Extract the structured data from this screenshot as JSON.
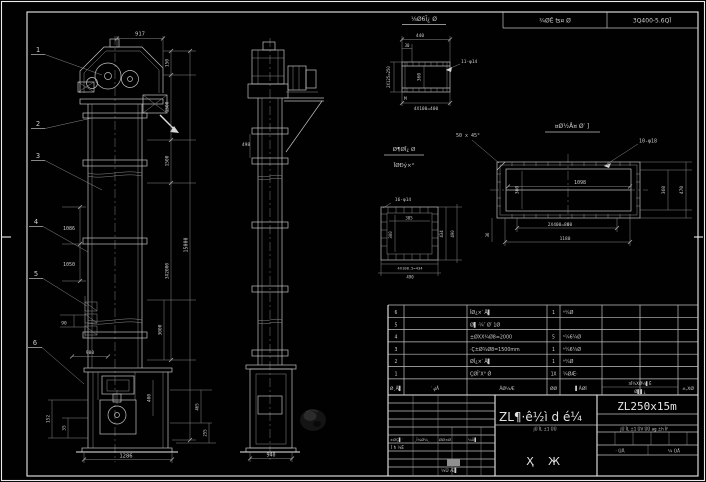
{
  "top_strip": {
    "cell1": "¾ØĒ ʦ¤ Ø",
    "cell2": "3Q400-5.6QĪ"
  },
  "balloons": {
    "b1": "1",
    "b2": "2",
    "b3": "3",
    "b4": "4",
    "b5": "5",
    "b6": "6"
  },
  "front": {
    "dim_top": "917",
    "dim_left_a": "1086",
    "dim_left_b": "1050",
    "dim_left_c": "90",
    "dim_right_a": "150",
    "dim_right_b": "1500",
    "dim_right_c": "1500",
    "dim_right_d": "3X2000",
    "dim_right_e": "3000",
    "dim_right_f": "400",
    "dim_total": "15000",
    "boot_dim_top": "900",
    "boot_dim_left_a": "152",
    "boot_dim_left_b": "35",
    "boot_dim_right_a": "465",
    "boot_dim_right_b": "255",
    "dim_bottom": "1286"
  },
  "side": {
    "dim_flange": "498",
    "dim_bottom": "940"
  },
  "detail_a": {
    "label": "⅛Ø6Ī¿ Ø",
    "dim_top": "440",
    "dim_offset": "30",
    "dim_left": "2X125=250",
    "dim_inner": "360",
    "holes": "11-φ14",
    "note": "M",
    "dim_bottom": "4X100=400"
  },
  "detail_b": {
    "label": "¤Ø½Å¤ Ø′ ]",
    "chamfer": "50 x 45°",
    "holes": "10-φ18",
    "dim_width": "1098",
    "dim_height": "360",
    "dim_right_a": "360",
    "dim_right_b": "470",
    "dim_bottom_a": "2X400=800",
    "dim_bottom_b": "1180",
    "dim_left": "36"
  },
  "detail_c": {
    "label1": "Ø¶ØĪ¿ Ø",
    "label2": "ĪØÐý×°",
    "holes": "16-φ14",
    "dim_inner_w": "305",
    "dim_inner_h": "300",
    "dim_right_a": "434",
    "dim_right_b": "490",
    "dim_bottom_a": "4X108.5=434",
    "dim_bottom_b": "490"
  },
  "bom": {
    "header": {
      "no": "Ø¸Å▌",
      "code": "′ ؼÅ",
      "name": "ÅØ¼Æ",
      "qty": "ØØ",
      "material": "▌ÅØĪ",
      "weight_top": "¤Ī¾XØ¼▌Ē",
      "weight_bottom": "Ø▌▌¿",
      "remark": "±,XØ"
    },
    "rows": [
      {
        "no": "6",
        "name": "ĪØ¿×′ Å▌",
        "qty": "1",
        "material": "ʰ¼Ø"
      },
      {
        "no": "5",
        "name": "Ø▌·¼″ Ø′ 1Ø",
        "qty": "",
        "material": ""
      },
      {
        "no": "4",
        "name": "±ØXX¾Ø8=2000",
        "qty": "5",
        "material": "ʰ¼6¼Ø"
      },
      {
        "no": "3",
        "name": "·Ç±Ø¾Ø8=1500mm",
        "qty": "1",
        "material": "ʰ¼6¼Ø"
      },
      {
        "no": "2",
        "name": "ØĪ¿×′ Å▌",
        "qty": "1",
        "material": "ʰ¼Ø"
      },
      {
        "no": "1",
        "name": "ÇØĪ″X° Ǿ",
        "qty": "1X",
        "material": "¼ØÆ·"
      }
    ]
  },
  "titleblock": {
    "title": "ZL¶·ê½ì d é¼",
    "model": "ZL250x15m",
    "char_a": "Ҳ",
    "char_b": "Ж",
    "std_row": "jŪ ĪL ±1 ŪV ŪŪ ag ±h Īf",
    "std_row_left": "jŪ ĪL ±1 ŪŪ",
    "sheet_a": "· ŪÅ",
    "sheet_b": "¼ ŪÅ",
    "sig_a": "±ØÇ▌′",
    "sig_b": "¸Ī¼Ø¼¸",
    "sig_c": "ØØ×Ø",
    "sig_d": "¼Ū▌",
    "sig_e": "Ī ħ ¼Ē",
    "sig_f": "¼Ū Æ▌"
  }
}
